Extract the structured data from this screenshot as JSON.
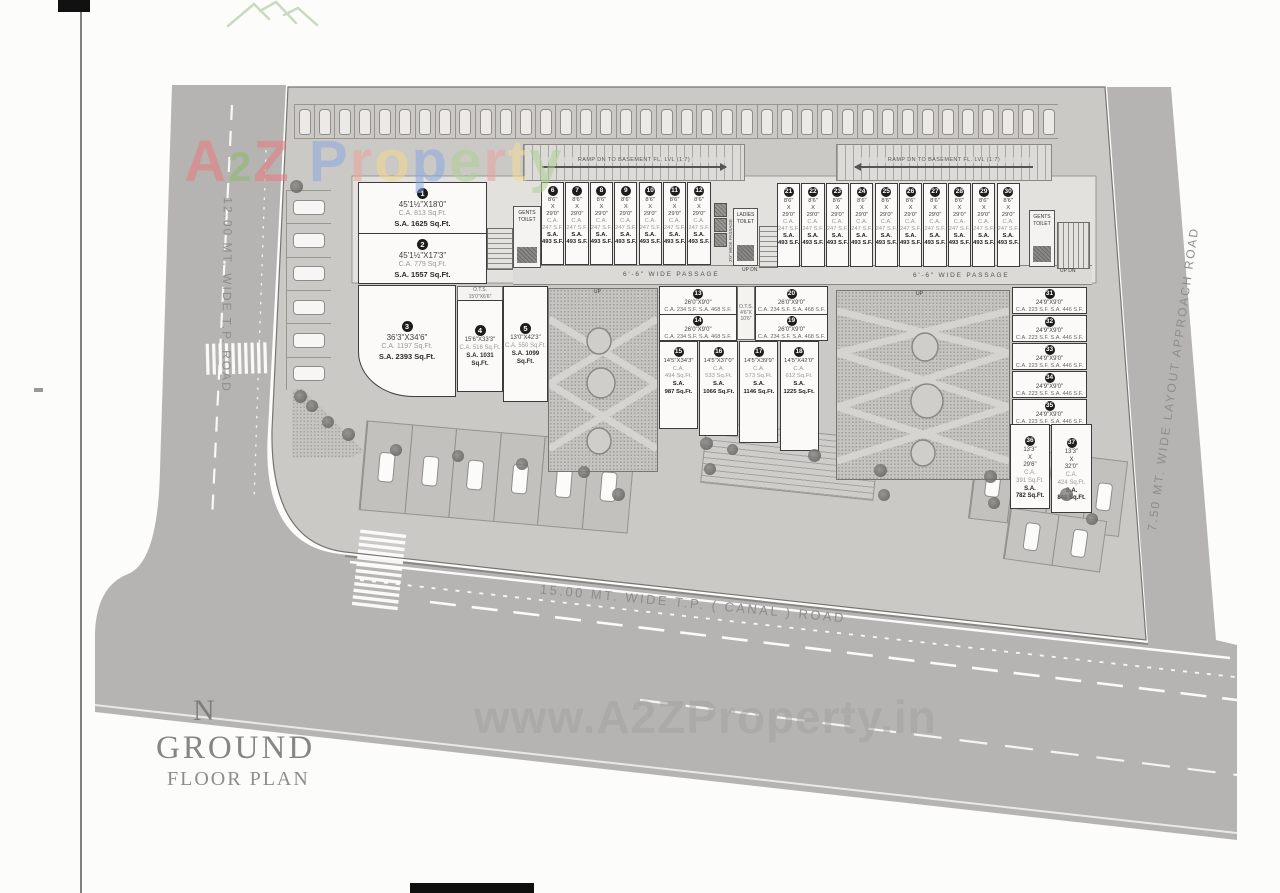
{
  "brand": {
    "letters": [
      {
        "ch": "A",
        "c": "#e8797b"
      },
      {
        "ch": "2",
        "c": "#8cba6b"
      },
      {
        "ch": "Z",
        "c": "#e8797b"
      },
      {
        "ch": " ",
        "c": "#ffffff"
      },
      {
        "ch": "P",
        "c": "#8aa8e0"
      },
      {
        "ch": "r",
        "c": "#eda49a"
      },
      {
        "ch": "o",
        "c": "#f3d88b"
      },
      {
        "ch": "p",
        "c": "#8aa8e0"
      },
      {
        "ch": "e",
        "c": "#aed191"
      },
      {
        "ch": "r",
        "c": "#e9a3a0"
      },
      {
        "ch": "t",
        "c": "#f3dd97"
      },
      {
        "ch": "y",
        "c": "#aed191"
      }
    ],
    "watermark": "www.A2ZProperty.in"
  },
  "plan_title": {
    "north": "N",
    "main": "GROUND",
    "sub": "FLOOR PLAN"
  },
  "roads": {
    "left": "12.00 MT. WIDE T.P.  ROAD",
    "bottom": "15.00 MT. WIDE T.P. ( CANAL ) ROAD",
    "right": "7.50 MT. WIDE LAYOUT APPROACH ROAD"
  },
  "ramps": {
    "left": "RAMP DN TO BASEMENT FL. LVL (1:7)",
    "right": "RAMP DN TO BASEMENT FL. LVL (1:7)"
  },
  "passage": {
    "left": "6'-6\" WIDE PASSAGE",
    "right": "6'-6\" WIDE PASSAGE"
  },
  "rooms": {
    "gents_left": "GENTS TOILET",
    "ladies": "LADIES TOILET",
    "gents_right": "GENTS TOILET"
  },
  "ots": {
    "left_l1": "O.T.S.",
    "left_l2": "15'0\"X6'6\"",
    "mid_l1": "O.T.S.",
    "mid_l2": "4'6\"X 10'6\""
  },
  "labels": {
    "up_dn": "UP DN",
    "up": "UP",
    "passage3": "3'0\" WIDE PASSAGE"
  },
  "units": {
    "large": [
      {
        "no": "1",
        "dims": "45'1½\"X18'0\"",
        "ca": "C.A. 813 Sq.Ft.",
        "sa": "S.A. 1625 Sq.Ft."
      },
      {
        "no": "2",
        "dims": "45'1½\"X17'3\"",
        "ca": "C.A. 779 Sq.Ft.",
        "sa": "S.A. 1557 Sq.Ft."
      },
      {
        "no": "3",
        "dims": "36'3\"X34'6\"",
        "ca": "C.A. 1197 Sq.Ft.",
        "sa": "S.A. 2393 Sq.Ft."
      },
      {
        "no": "4",
        "dims": "15'6\"X33'3\"",
        "ca": "C.A. 516 Sq.Ft.",
        "sa": "S.A. 1031 Sq.Ft."
      },
      {
        "no": "5",
        "dims": "13'0\"X42'3\"",
        "ca": "C.A. 550 Sq.Ft.",
        "sa": "S.A. 1099 Sq.Ft."
      }
    ],
    "shop_spec": {
      "w": "8'6\"",
      "x": "X",
      "d": "29'0\"",
      "ca_l": "C.A.",
      "ca": "247 S.F.",
      "sa_l": "S.A.",
      "sa": "493 S.F."
    },
    "shops_top_left": [
      "6",
      "7",
      "8",
      "9",
      "10",
      "11",
      "12"
    ],
    "shops_top_right": [
      "21",
      "22",
      "23",
      "24",
      "25",
      "26",
      "27",
      "28",
      "29",
      "30"
    ],
    "strip_mid": [
      {
        "no": "13",
        "dims": "26'0\"X9'0\"",
        "area": "C.A. 234 S.F.  S.A. 468 S.F."
      },
      {
        "no": "20",
        "dims": "26'0\"X9'0\"",
        "area": "C.A. 234 S.F.  S.A. 468 S.F."
      },
      {
        "no": "14",
        "dims": "26'0\"X9'0\"",
        "area": "C.A. 234 S.F.  S.A. 468 S.F."
      },
      {
        "no": "19",
        "dims": "26'0\"X9'0\"",
        "area": "C.A. 234 S.F.  S.A. 468 S.F."
      }
    ],
    "shops_mid": [
      {
        "no": "15",
        "dims": "14'5\"X34'3\"",
        "ca_l": "C.A.",
        "ca": "494 Sq.Ft.",
        "sa_l": "S.A.",
        "sa": "987 Sq.Ft."
      },
      {
        "no": "16",
        "dims": "14'5\"X37'0\"",
        "ca_l": "C.A.",
        "ca": "533 Sq.Ft.",
        "sa_l": "S.A.",
        "sa": "1066 Sq.Ft."
      },
      {
        "no": "17",
        "dims": "14'5\"X39'9\"",
        "ca_l": "C.A.",
        "ca": "573 Sq.Ft.",
        "sa_l": "S.A.",
        "sa": "1146 Sq.Ft."
      },
      {
        "no": "18",
        "dims": "14'5\"X42'0\"",
        "ca_l": "C.A.",
        "ca": "612 Sq.Ft.",
        "sa_l": "S.A.",
        "sa": "1225 Sq.Ft."
      }
    ],
    "strip_right": [
      {
        "no": "31",
        "dims": "24'9\"X9'0\"",
        "area": "C.A. 223 S.F.  S.A. 446 S.F."
      },
      {
        "no": "32",
        "dims": "24'9\"X9'0\"",
        "area": "C.A. 223 S.F.  S.A. 446 S.F."
      },
      {
        "no": "33",
        "dims": "24'9\"X9'0\"",
        "area": "C.A. 223 S.F.  S.A. 446 S.F."
      },
      {
        "no": "34",
        "dims": "24'9\"X9'0\"",
        "area": "C.A. 223 S.F.  S.A. 446 S.F."
      },
      {
        "no": "35",
        "dims": "24'9\"X9'0\"",
        "area": "C.A. 223 S.F.  S.A. 446 S.F."
      }
    ],
    "shops_right": [
      {
        "no": "36",
        "w": "13'3\"",
        "x": "X",
        "d": "29'6\"",
        "ca_l": "C.A.",
        "ca": "391 Sq.Ft.",
        "sa_l": "S.A.",
        "sa": "782 Sq.Ft."
      },
      {
        "no": "37",
        "w": "13'3\"",
        "x": "X",
        "d": "32'0\"",
        "ca_l": "C.A.",
        "ca": "424 Sq.Ft.",
        "sa_l": "S.A.",
        "sa": "848 Sq.Ft."
      }
    ]
  },
  "site": {
    "top_parking_stalls": 38,
    "left_parking_stalls": 6,
    "bay_group_a": 6,
    "bay_group_b": 4,
    "bay_group_c": 2
  }
}
